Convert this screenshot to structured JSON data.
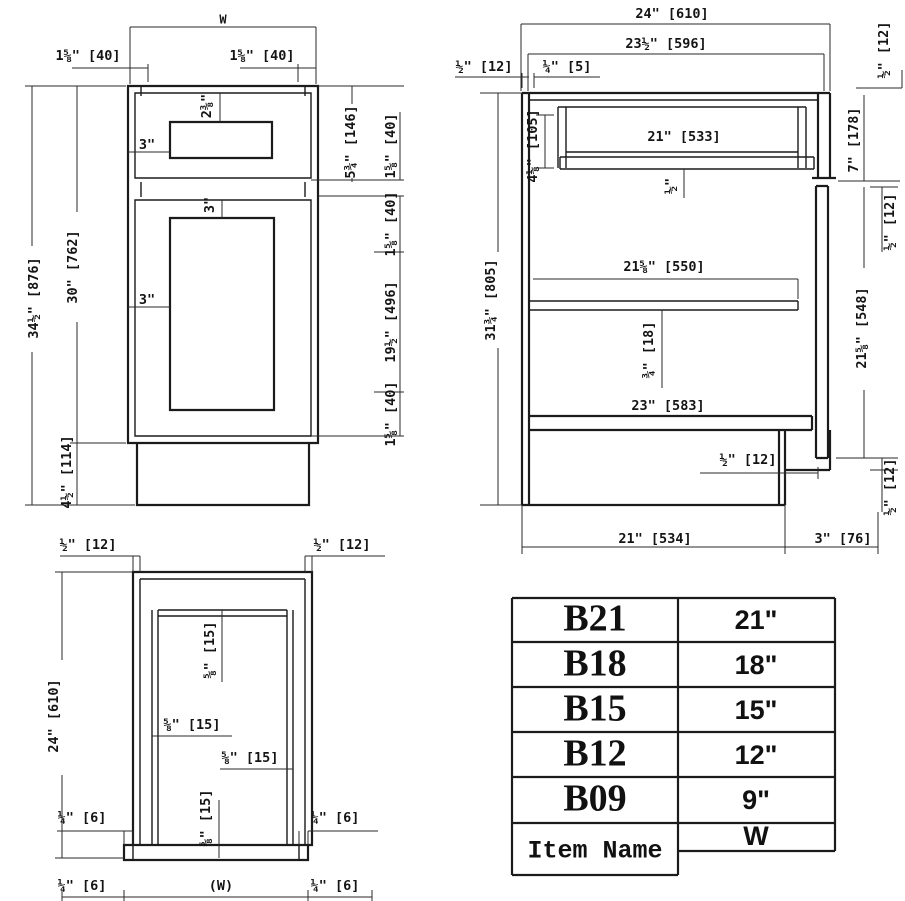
{
  "front_view": {
    "top_width_label": "W",
    "top_left_offset": "1⅝\" [40]",
    "top_right_offset": "1⅝\" [40]",
    "overall_height": "34½\" [876]",
    "body_height": "30\" [762]",
    "toe_kick_height": "4½\" [114]",
    "drawer_front_height": "5¾\" [146]",
    "drawer_rail": "1⅝\" [40]",
    "door_top_rail": "1⅝\" [40]",
    "door_panel_height": "19½\" [496]",
    "door_bottom_rail": "1⅝\" [40]",
    "drawer_handle_inset": "3\"",
    "drawer_handle_drop": "2⅜\"",
    "door_handle_drop": "3\"",
    "door_panel_inset": "3\""
  },
  "side_view": {
    "overall_depth": "24\" [610]",
    "interior_depth": "23½\" [596]",
    "back_panel": "½\" [12]",
    "back_clearance": "¼\" [5]",
    "top_overhang": "½\" [12]",
    "overall_height": "31¾\" [805]",
    "drawer_opening": "4⅛\" [105]",
    "drawer_depth": "21\" [533]",
    "drawer_bottom": "½\"",
    "shelf_depth": "21⅝\" [550]",
    "shelf_thickness": "¾\" [18]",
    "bottom_depth": "23\" [583]",
    "toe_board": "½\" [12]",
    "top_rail_height": "7\" [178]",
    "door_top_gap": "½\" [12]",
    "door_height": "21⅝\" [548]",
    "door_bottom_gap": "½\" [12]",
    "floor_depth": "21\" [534]",
    "toe_recess": "3\" [76]"
  },
  "plan_view": {
    "left_panel": "½\" [12]",
    "right_panel": "½\" [12]",
    "depth": "24\" [610]",
    "back_thickness": "⅝\" [15]",
    "left_thickness": "⅝\" [15]",
    "right_thickness": "⅝\" [15]",
    "door_thickness": "⅝\" [15]",
    "left_reveal": "¼\" [6]",
    "right_reveal": "¼\" [6]",
    "bottom_left_reveal": "¼\" [6]",
    "door_width": "(W)",
    "bottom_right_reveal": "¼\" [6]"
  },
  "size_table": {
    "rows": [
      {
        "item": "B21",
        "width": "21\""
      },
      {
        "item": "B18",
        "width": "18\""
      },
      {
        "item": "B15",
        "width": "15\""
      },
      {
        "item": "B12",
        "width": "12\""
      },
      {
        "item": "B09",
        "width": "9\""
      }
    ],
    "footer_item": "Item Name",
    "footer_width": "W"
  }
}
